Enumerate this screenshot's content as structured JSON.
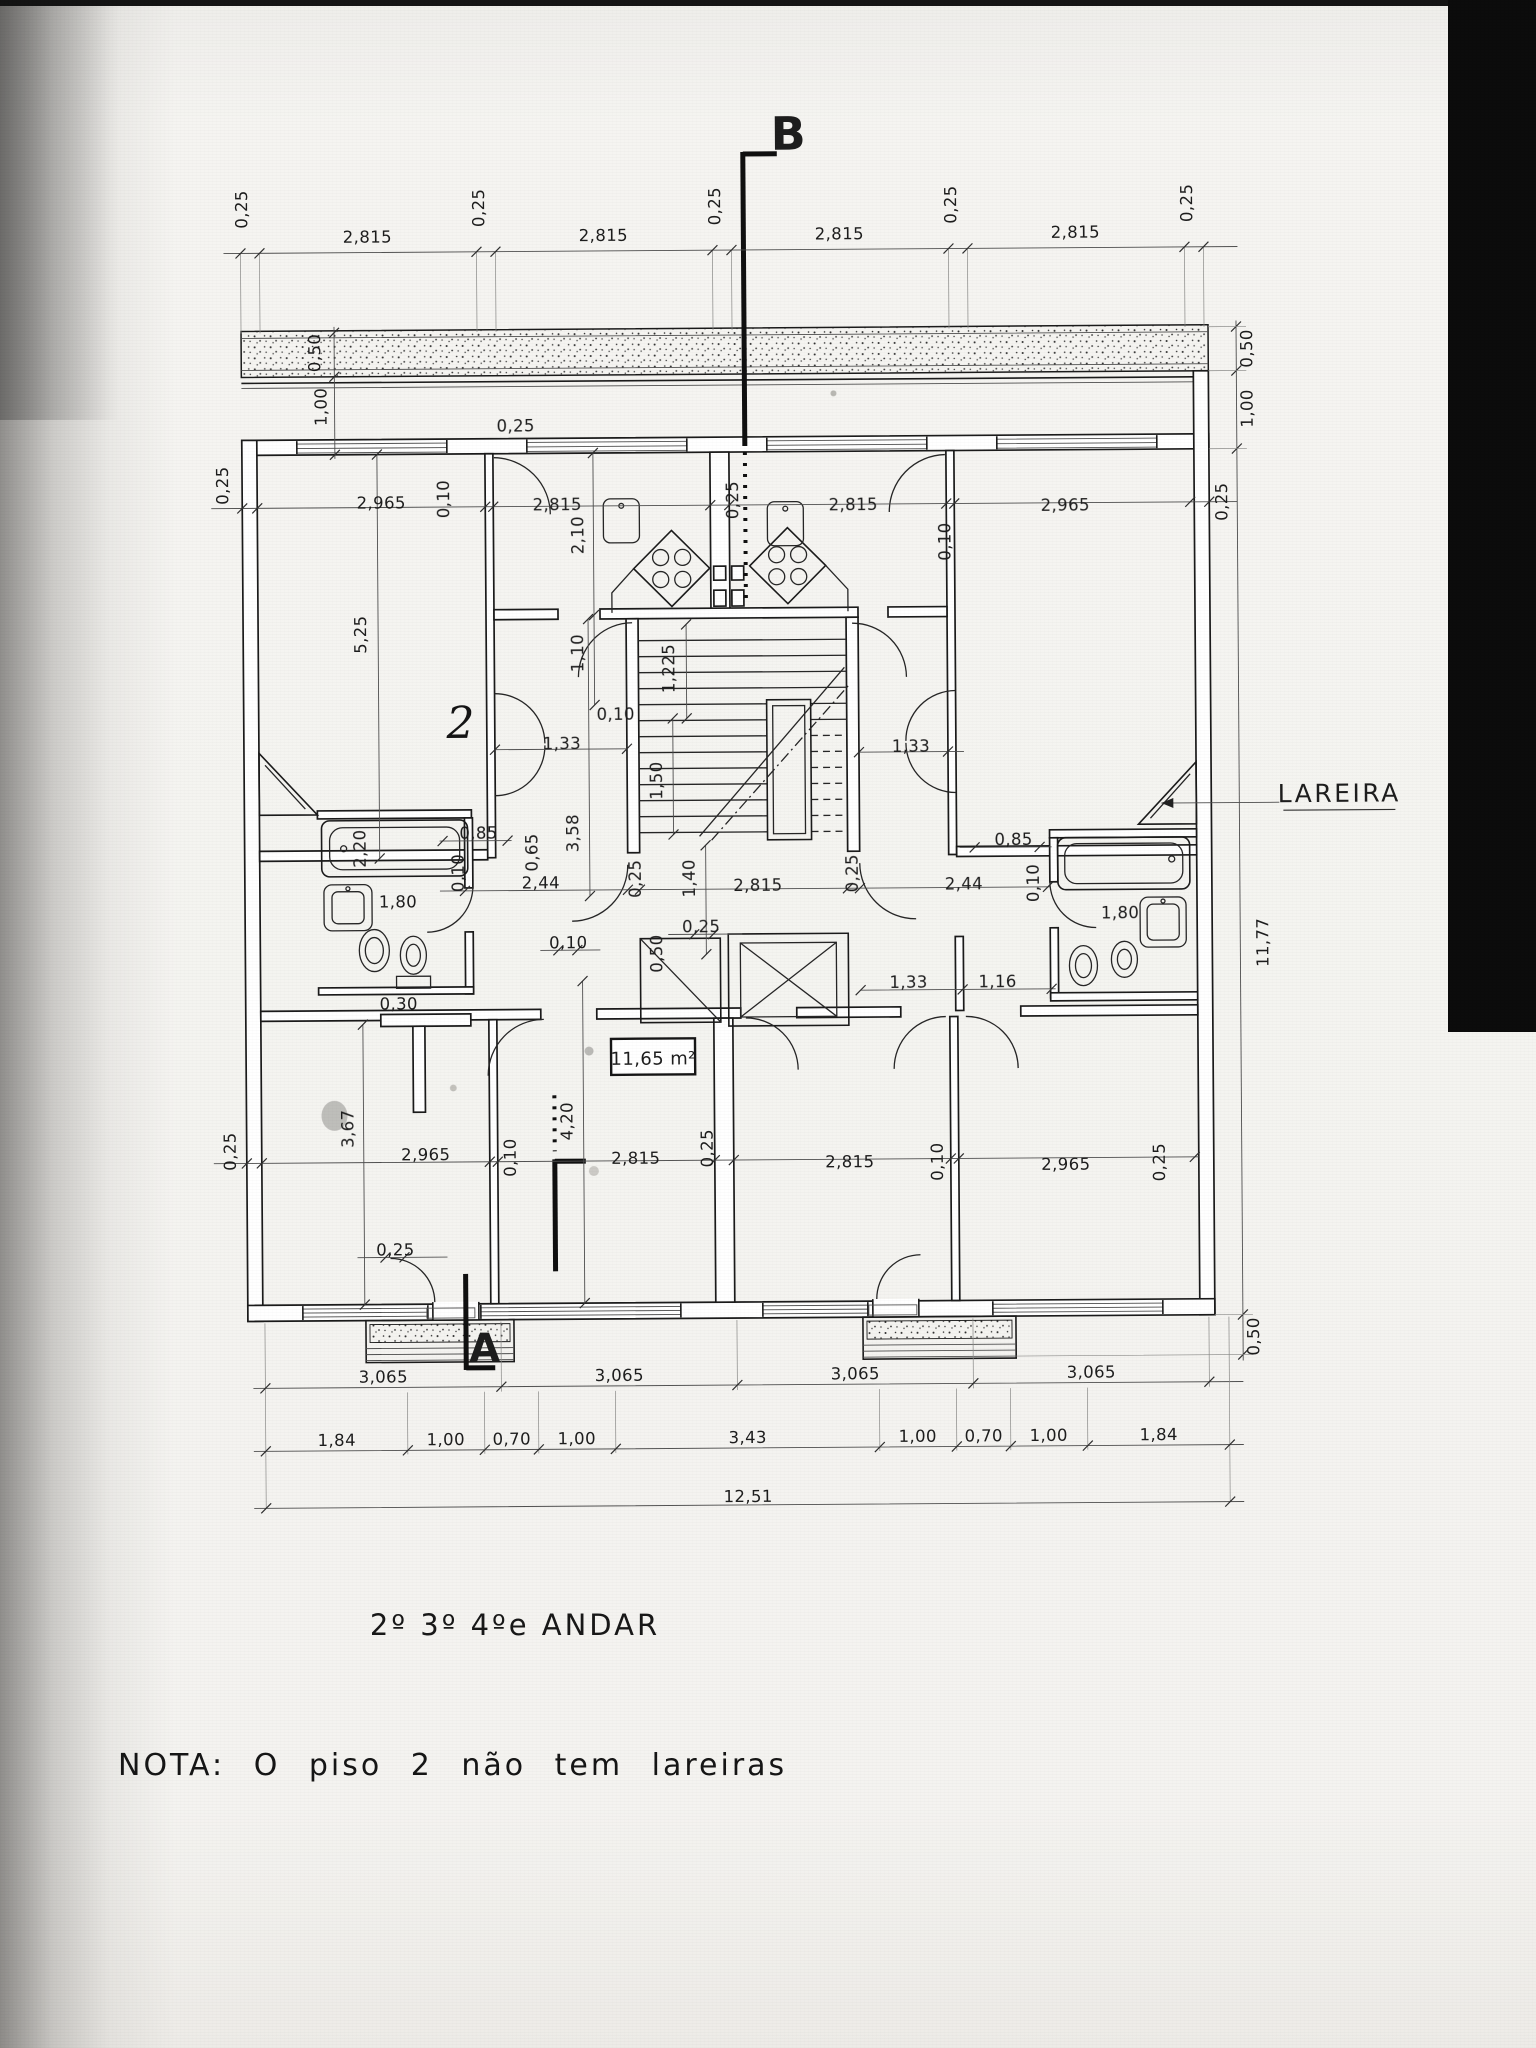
{
  "page": {
    "paper_color": "#f4f3f0",
    "ink_color": "#1c1c1c",
    "scan_bar_color": "#0c0c0c",
    "kind": "scanned architectural floor plan"
  },
  "title": {
    "text": "2º 3º 4ºe ANDAR"
  },
  "note": {
    "text": "NOTA: O  piso 2  não  tem  lareiras"
  },
  "plan": {
    "area_box_label": "11,65 m²",
    "fireplace_label": "LAREIRA",
    "section_markers": [
      "B",
      "A"
    ],
    "total_width_label": "12,51",
    "total_height_label": "11,77",
    "labels": [
      {
        "t": "0,25",
        "x": 252,
        "y": 206,
        "r": -90
      },
      {
        "t": "2,815",
        "x": 372,
        "y": 240
      },
      {
        "t": "0,25",
        "x": 489,
        "y": 206,
        "r": -90
      },
      {
        "t": "2,815",
        "x": 608,
        "y": 240
      },
      {
        "t": "0,25",
        "x": 725,
        "y": 206,
        "r": -90
      },
      {
        "t": "2,815",
        "x": 844,
        "y": 240
      },
      {
        "t": "0,25",
        "x": 961,
        "y": 206,
        "r": -90
      },
      {
        "t": "2,815",
        "x": 1080,
        "y": 240
      },
      {
        "t": "0,25",
        "x": 1197,
        "y": 206,
        "r": -90
      },
      {
        "t": "0,50",
        "x": 1256,
        "y": 352,
        "r": -90
      },
      {
        "t": "1,00",
        "x": 1256,
        "y": 412,
        "r": -90
      },
      {
        "t": "0,25",
        "x": 1230,
        "y": 505,
        "r": -90
      },
      {
        "t": "11,77",
        "x": 1268,
        "y": 946,
        "r": -90
      },
      {
        "t": "0,50",
        "x": 1256,
        "y": 1340,
        "r": -90
      },
      {
        "t": "0,50",
        "x": 324,
        "y": 350,
        "r": -90
      },
      {
        "t": "1,00",
        "x": 330,
        "y": 404,
        "r": -90
      },
      {
        "t": "0,25",
        "x": 231,
        "y": 482,
        "r": -90
      },
      {
        "t": "5,25",
        "x": 368,
        "y": 632,
        "r": -90
      },
      {
        "t": "0,25",
        "x": 234,
        "y": 1148,
        "r": -90
      },
      {
        "t": "3,67",
        "x": 352,
        "y": 1126,
        "r": -90
      },
      {
        "t": "2,965",
        "x": 384,
        "y": 506
      },
      {
        "t": "0,10",
        "x": 452,
        "y": 497,
        "r": -90
      },
      {
        "t": "2,815",
        "x": 560,
        "y": 509
      },
      {
        "t": "0,25",
        "x": 519,
        "y": 430
      },
      {
        "t": "2,10",
        "x": 586,
        "y": 534,
        "r": -90
      },
      {
        "t": "0,25",
        "x": 741,
        "y": 500,
        "r": -90
      },
      {
        "t": "2,815",
        "x": 856,
        "y": 511
      },
      {
        "t": "0,10",
        "x": 953,
        "y": 543,
        "r": -90
      },
      {
        "t": "2,965",
        "x": 1068,
        "y": 513
      },
      {
        "t": "1,10",
        "x": 585,
        "y": 652,
        "r": -90
      },
      {
        "t": "1,225",
        "x": 676,
        "y": 668,
        "r": -90
      },
      {
        "t": "0,10",
        "x": 617,
        "y": 719
      },
      {
        "t": "1,33",
        "x": 563,
        "y": 748
      },
      {
        "t": "1,50",
        "x": 663,
        "y": 780,
        "r": -90
      },
      {
        "t": "3,58",
        "x": 579,
        "y": 832,
        "r": -90
      },
      {
        "t": "1,40",
        "x": 695,
        "y": 878,
        "r": -90
      },
      {
        "t": "2,815",
        "x": 758,
        "y": 891
      },
      {
        "t": "0,25",
        "x": 641,
        "y": 878,
        "r": -90
      },
      {
        "t": "0,25",
        "x": 858,
        "y": 874,
        "r": -90
      },
      {
        "t": "0,25",
        "x": 701,
        "y": 932
      },
      {
        "t": "0,50",
        "x": 662,
        "y": 953,
        "r": -90
      },
      {
        "t": "1,33",
        "x": 912,
        "y": 753
      },
      {
        "t": "0,85",
        "x": 1014,
        "y": 847
      },
      {
        "t": "2,44",
        "x": 964,
        "y": 891
      },
      {
        "t": "0,10",
        "x": 1039,
        "y": 885,
        "r": -90
      },
      {
        "t": "1,80",
        "x": 1120,
        "y": 921
      },
      {
        "t": "1,33",
        "x": 908,
        "y": 989
      },
      {
        "t": "1,16",
        "x": 997,
        "y": 989
      },
      {
        "t": "2,20",
        "x": 366,
        "y": 846,
        "r": -90
      },
      {
        "t": "0,85",
        "x": 479,
        "y": 837
      },
      {
        "t": "0,65",
        "x": 538,
        "y": 851,
        "r": -90
      },
      {
        "t": "0,10",
        "x": 464,
        "y": 871,
        "r": -90
      },
      {
        "t": "2,44",
        "x": 541,
        "y": 887
      },
      {
        "t": "1,80",
        "x": 398,
        "y": 905
      },
      {
        "t": "0,10",
        "x": 568,
        "y": 947
      },
      {
        "t": "0,30",
        "x": 398,
        "y": 1007
      },
      {
        "t": "2,965",
        "x": 424,
        "y": 1158
      },
      {
        "t": "0,10",
        "x": 514,
        "y": 1156,
        "r": -90
      },
      {
        "t": "4,20",
        "x": 571,
        "y": 1120,
        "r": -90
      },
      {
        "t": "2,815",
        "x": 634,
        "y": 1163
      },
      {
        "t": "0,25",
        "x": 711,
        "y": 1148,
        "r": -90
      },
      {
        "t": "2,815",
        "x": 848,
        "y": 1168
      },
      {
        "t": "0,10",
        "x": 941,
        "y": 1163,
        "r": -90
      },
      {
        "t": "2,965",
        "x": 1064,
        "y": 1172
      },
      {
        "t": "0,25",
        "x": 1163,
        "y": 1165,
        "r": -90
      },
      {
        "t": "0,25",
        "x": 393,
        "y": 1253
      },
      {
        "t": "3,065",
        "x": 380,
        "y": 1380
      },
      {
        "t": "3,065",
        "x": 616,
        "y": 1380
      },
      {
        "t": "3,065",
        "x": 852,
        "y": 1380
      },
      {
        "t": "3,065",
        "x": 1088,
        "y": 1380
      },
      {
        "t": "1,84",
        "x": 333,
        "y": 1443
      },
      {
        "t": "1,00",
        "x": 442,
        "y": 1443
      },
      {
        "t": "0,70",
        "x": 508,
        "y": 1443
      },
      {
        "t": "1,00",
        "x": 573,
        "y": 1443
      },
      {
        "t": "3,43",
        "x": 744,
        "y": 1443
      },
      {
        "t": "1,00",
        "x": 914,
        "y": 1443
      },
      {
        "t": "0,70",
        "x": 980,
        "y": 1443
      },
      {
        "t": "1,00",
        "x": 1045,
        "y": 1443
      },
      {
        "t": "1,84",
        "x": 1155,
        "y": 1443
      },
      {
        "t": "12,51",
        "x": 744,
        "y": 1502
      },
      {
        "t": "B",
        "x": 794,
        "y": 150,
        "s": 46,
        "cls": "marker",
        "name": "section-marker-b"
      },
      {
        "t": "A",
        "x": 482,
        "y": 1360,
        "s": 40,
        "cls": "marker",
        "name": "section-marker-a"
      },
      {
        "t": "LAREIRA",
        "x": 1340,
        "y": 806,
        "s": 25,
        "cls": "lareira",
        "name": "fireplace-label"
      },
      {
        "t": "11,65 m²",
        "x": 652,
        "y": 1064,
        "s": 18,
        "name": "area-label"
      },
      {
        "t": "2",
        "x": 462,
        "y": 736,
        "s": 44,
        "cls": "hand",
        "name": "handwritten-mark"
      }
    ]
  }
}
